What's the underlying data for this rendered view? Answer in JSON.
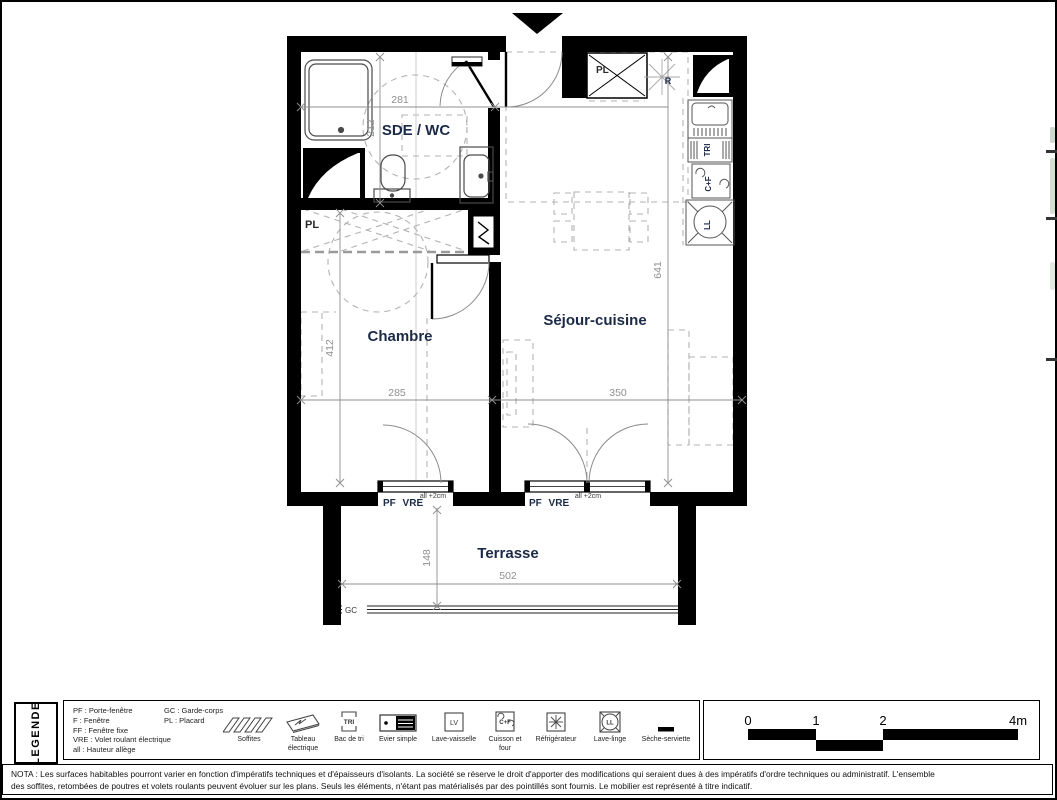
{
  "plan": {
    "rooms": {
      "bathroom": "SDE / WC",
      "bedroom": "Chambre",
      "living": "Séjour-cuisine",
      "terrace": "Terrasse"
    },
    "labels": {
      "closet_entry": "PL",
      "closet_bedroom": "PL",
      "fridge": "R",
      "sorting": "TRI",
      "cooking": "C+F",
      "washer": "LL",
      "window_left": "PF VRE",
      "window_right": "PF VRE",
      "sill_left": "all +2cm",
      "sill_right": "all +2cm",
      "railing": "GC"
    },
    "dims": {
      "bath_w": "281",
      "bath_h": "212",
      "bed_h": "412",
      "bed_w": "285",
      "living_w": "350",
      "living_h": "641",
      "terrace_d": "148",
      "terrace_w": "502"
    }
  },
  "legend": {
    "title": "LEGENDE",
    "abbr_col1": [
      "PF : Porte-fenêtre",
      "F : Fenêtre",
      "FF : Fenêtre fixe",
      "VRE : Volet roulant électrique",
      "all : Hauteur allège"
    ],
    "abbr_col2": [
      "GC : Garde-corps",
      "PL : Placard"
    ],
    "items": [
      {
        "icon": "soffites-icon",
        "label": "Soffites"
      },
      {
        "icon": "electrical-panel-icon",
        "label": "Tableau électrique"
      },
      {
        "icon": "recycling-bin-icon",
        "label": "Bac de tri",
        "glyph": "TRI"
      },
      {
        "icon": "sink-icon",
        "label": "Evier simple"
      },
      {
        "icon": "dishwasher-icon",
        "label": "Lave-vaisselle",
        "glyph": "LV"
      },
      {
        "icon": "stove-oven-icon",
        "label": "Cuisson et four",
        "glyph": "C+F"
      },
      {
        "icon": "fridge-icon",
        "label": "Réfrigérateur"
      },
      {
        "icon": "washing-machine-icon",
        "label": "Lave-linge",
        "glyph": "LL"
      },
      {
        "icon": "towel-dryer-icon",
        "label": "Sèche-serviette"
      }
    ]
  },
  "scale_bar": {
    "ticks": [
      "0",
      "1",
      "2",
      "4m"
    ]
  },
  "nota": {
    "line1": "NOTA : Les surfaces habitables pourront varier en fonction d'impératifs techniques et d'épaisseurs d'isolants. La société se réserve le droit d'apporter des modifications qui seraient dues à des impératifs d'ordre techniques ou administratif. L'ensemble",
    "line2": "des soffites, retombées de poutres et volets roulants peuvent évoluer sur les plans. Seuls les éléments, n'étant pas matérialisés par des pointillés sont fournis. Le mobilier est représenté à titre indicatif."
  },
  "colors": {
    "wall": "#000000",
    "room_label": "#1b2a47",
    "dimension": "#8f8f8f",
    "furniture_dash": "#b3b3b3"
  }
}
